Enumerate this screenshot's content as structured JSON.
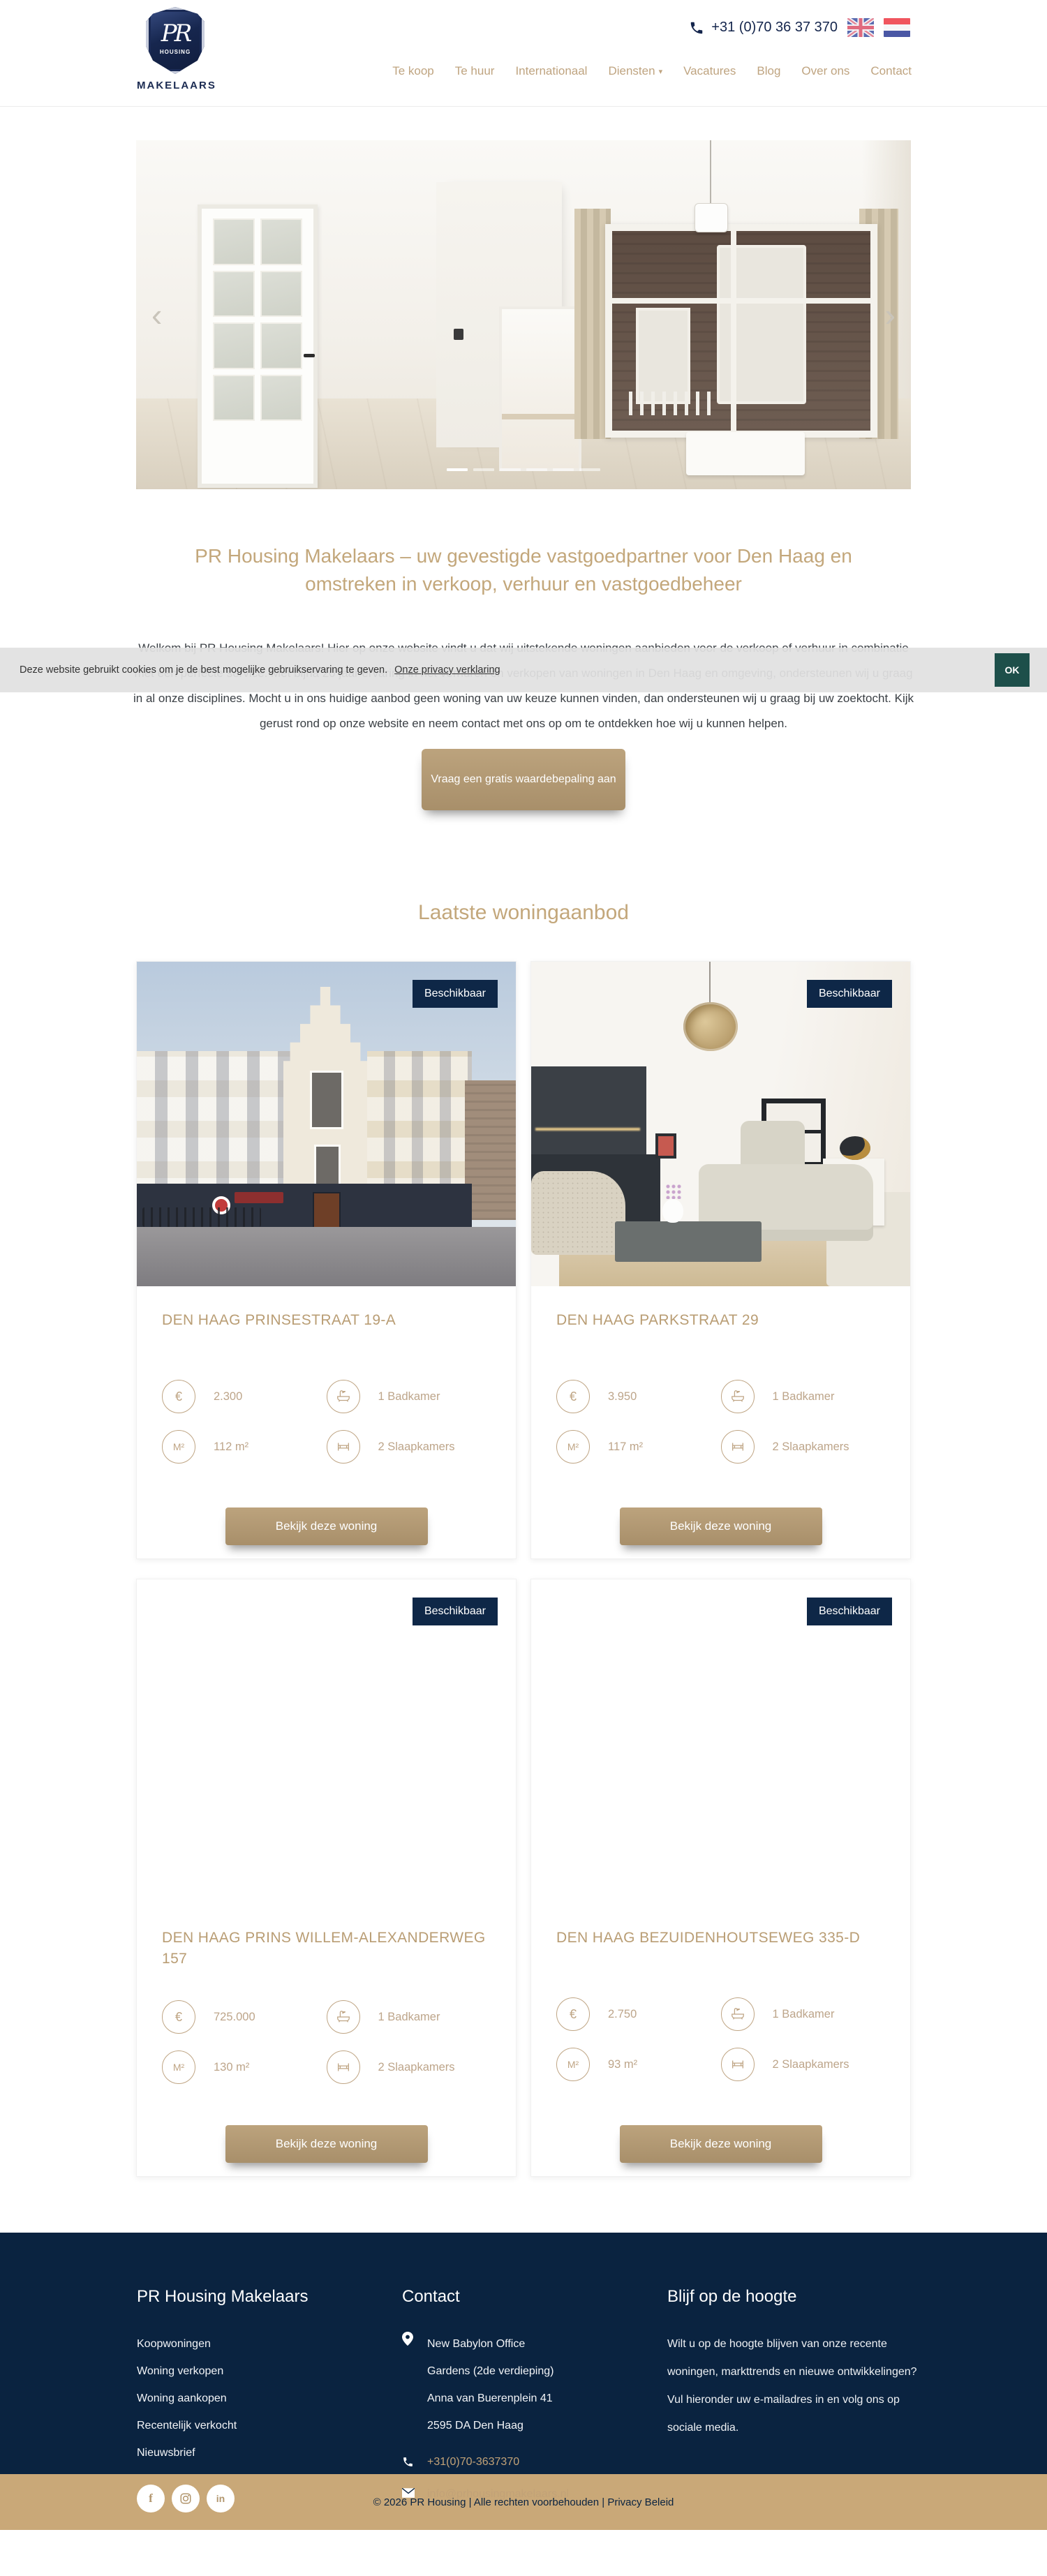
{
  "header": {
    "logo": {
      "monogram": "PR",
      "sub": "HOUSING",
      "label": "MAKELAARS"
    },
    "phone": "+31 (0)70 36 37 370",
    "nav": [
      {
        "label": "Te koop"
      },
      {
        "label": "Te huur"
      },
      {
        "label": "Internationaal"
      },
      {
        "label": "Diensten",
        "caret": "▾"
      },
      {
        "label": "Vacatures"
      },
      {
        "label": "Blog"
      },
      {
        "label": "Over ons"
      },
      {
        "label": "Contact"
      }
    ]
  },
  "hero": {
    "prev": "‹",
    "next": "›"
  },
  "cookie": {
    "message": "Deze website gebruikt cookies om je de best mogelijke gebruikservaring te geven.",
    "link": "Onze privacy verklaring",
    "ok": "OK"
  },
  "intro": {
    "heading": "PR Housing Makelaars – uw gevestigde vastgoedpartner voor Den Haag en omstreken in verkoop, verhuur en vastgoedbeheer",
    "paragraph": "Welkom bij PR Housing Makelaars! Hier op onze website vindt u dat wij uitstekende woningen aanbieden voor de verkoop of verhuur in combinatie met een perfecte service. Met bijna 20 jaar ervaring in het verhuren en verkopen van woningen in Den Haag en omgeving, ondersteunen wij u graag in al onze disciplines. Mocht u in ons huidige aanbod geen woning van uw keuze kunnen vinden, dan ondersteunen wij u graag bij uw zoektocht. Kijk gerust rond op onze website en neem contact met ons op om te ontdekken hoe wij u kunnen helpen.",
    "cta": "Vraag een gratis waardebepaling aan"
  },
  "listings": {
    "heading": "Laatste woningaanbod",
    "badge": "Beschikbaar",
    "view_button": "Bekijk deze woning",
    "icons": {
      "euro": "€",
      "area": "M²"
    },
    "items": [
      {
        "title": "DEN HAAG PRINSESTRAAT 19-A",
        "price": "2.300",
        "bath": "1 Badkamer",
        "area": "112 m²",
        "bedrooms": "2 Slaapkamers"
      },
      {
        "title": "DEN HAAG PARKSTRAAT 29",
        "price": "3.950",
        "bath": "1 Badkamer",
        "area": "117 m²",
        "bedrooms": "2 Slaapkamers"
      },
      {
        "title": "DEN HAAG PRINS WILLEM-ALEXANDERWEG 157",
        "price": "725.000",
        "bath": "1 Badkamer",
        "area": "130 m²",
        "bedrooms": "2 Slaapkamers"
      },
      {
        "title": "DEN HAAG BEZUIDENHOUTSEWEG 335-D",
        "price": "2.750",
        "bath": "1 Badkamer",
        "area": "93 m²",
        "bedrooms": "2 Slaapkamers"
      }
    ]
  },
  "footer": {
    "brand": {
      "heading": "PR Housing Makelaars",
      "links": [
        "Koopwoningen",
        "Woning verkopen",
        "Woning aankopen",
        "Recentelijk verkocht",
        "Nieuwsbrief"
      ]
    },
    "contact": {
      "heading": "Contact",
      "address_lines": [
        "New Babylon Office",
        "Gardens (2de verdieping)",
        "Anna van Buerenplein 41",
        "2595 DA Den Haag"
      ],
      "phone": "+31(0)70-3637370",
      "email": "info@prhousingmakelaars.nl"
    },
    "newsletter": {
      "heading": "Blijf op de hoogte",
      "text": "Wilt u op de hoogte blijven van onze recente woningen, markttrends en nieuwe ontwikkelingen? Vul hieronder uw e-mailadres in en volg ons op sociale media."
    },
    "copyright_prefix": "© 2026 PR Housing | Alle rechten voorbehouden | ",
    "privacy_link": "Privacy Beleid"
  },
  "colors": {
    "gold": "#bfa480",
    "heading_gold": "#c3a77b",
    "button_tan": "#b49a75",
    "navy": "#0a2340",
    "badge_navy": "#0e2747",
    "cookie_ok_teal": "#1d4f4a",
    "bottom_bar_tan": "#c9a878"
  }
}
